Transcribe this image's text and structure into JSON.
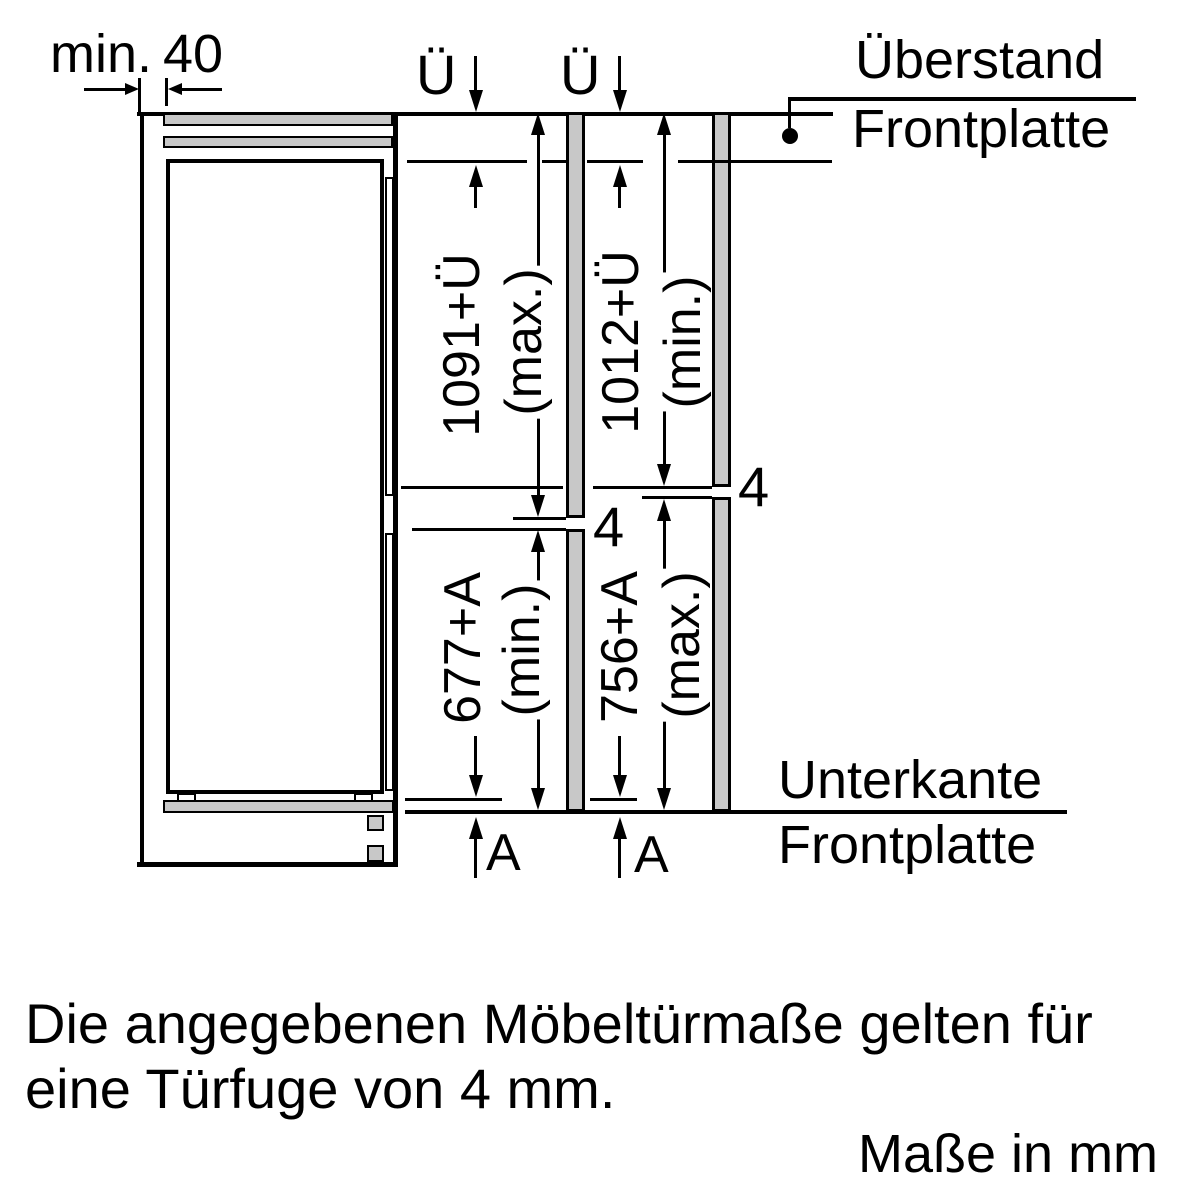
{
  "labels": {
    "min_clearance": {
      "prefix": "min.",
      "value": "40"
    },
    "overhang_title": "Überstand",
    "overhang_subtitle": "Frontplatte",
    "bottom_edge_title": "Unterkante",
    "bottom_edge_subtitle": "Frontplatte",
    "overhang_symbol_left": "Ü",
    "overhang_symbol_right": "Ü",
    "offset_symbol_left": "A",
    "offset_symbol_right": "A",
    "gap_value_left": "4",
    "gap_value_right": "4"
  },
  "dimensions": {
    "upper_left": {
      "value": "1091+Ü",
      "qualifier": "(max.)"
    },
    "upper_right": {
      "value": "1012+Ü",
      "qualifier": "(min.)"
    },
    "lower_left": {
      "value": "677+A",
      "qualifier": "(min.)"
    },
    "lower_right": {
      "value": "756+A",
      "qualifier": "(max.)"
    }
  },
  "footnote": {
    "line1": "Die angegebenen Möbeltürmaße gelten für",
    "line2": "eine Türfuge von 4 mm."
  },
  "units_note": "Maße in mm",
  "colors": {
    "line": "#000000",
    "panel_fill": "#c8c8c8",
    "background": "#ffffff"
  }
}
